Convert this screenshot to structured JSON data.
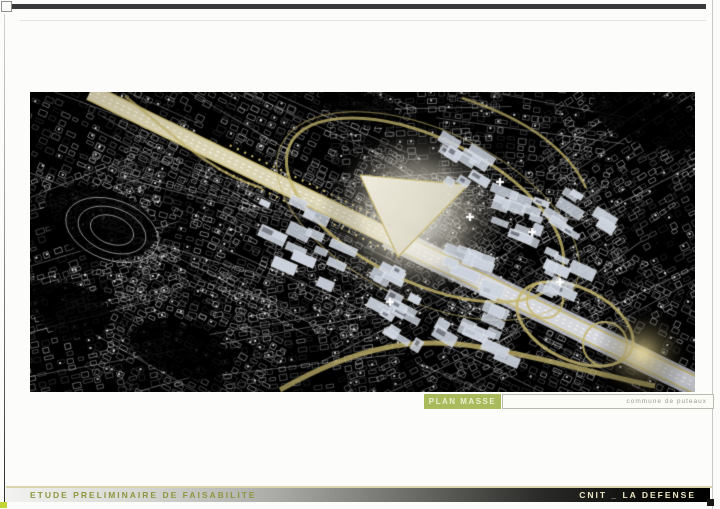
{
  "captions": {
    "plan_masse": "PLAN MASSE",
    "commune": "commune de puteaux"
  },
  "footer": {
    "title": "ETUDE PRELIMINAIRE DE FAISABILITE",
    "project": "CNIT _ LA DEFENSE"
  },
  "colors": {
    "badge_green": "#a8ba5c",
    "footer_title_olive": "#8f9640",
    "footer_project_cream": "#ece7c3",
    "corner_chip_yellow": "#c3d434",
    "top_rule_gray": "#39393b"
  },
  "map": {
    "description": "black-background urban plan of La Defense with white block linework, golden ring roads, cream historic axis and light grey building slabs",
    "colors": {
      "background": "#000000",
      "linework": "#ffffff",
      "gold_road": "#c6b66e",
      "axis_cream": "#e9e0ba",
      "avenue_grey": "#d7dae1",
      "building_slab": "#ccd3de"
    }
  }
}
